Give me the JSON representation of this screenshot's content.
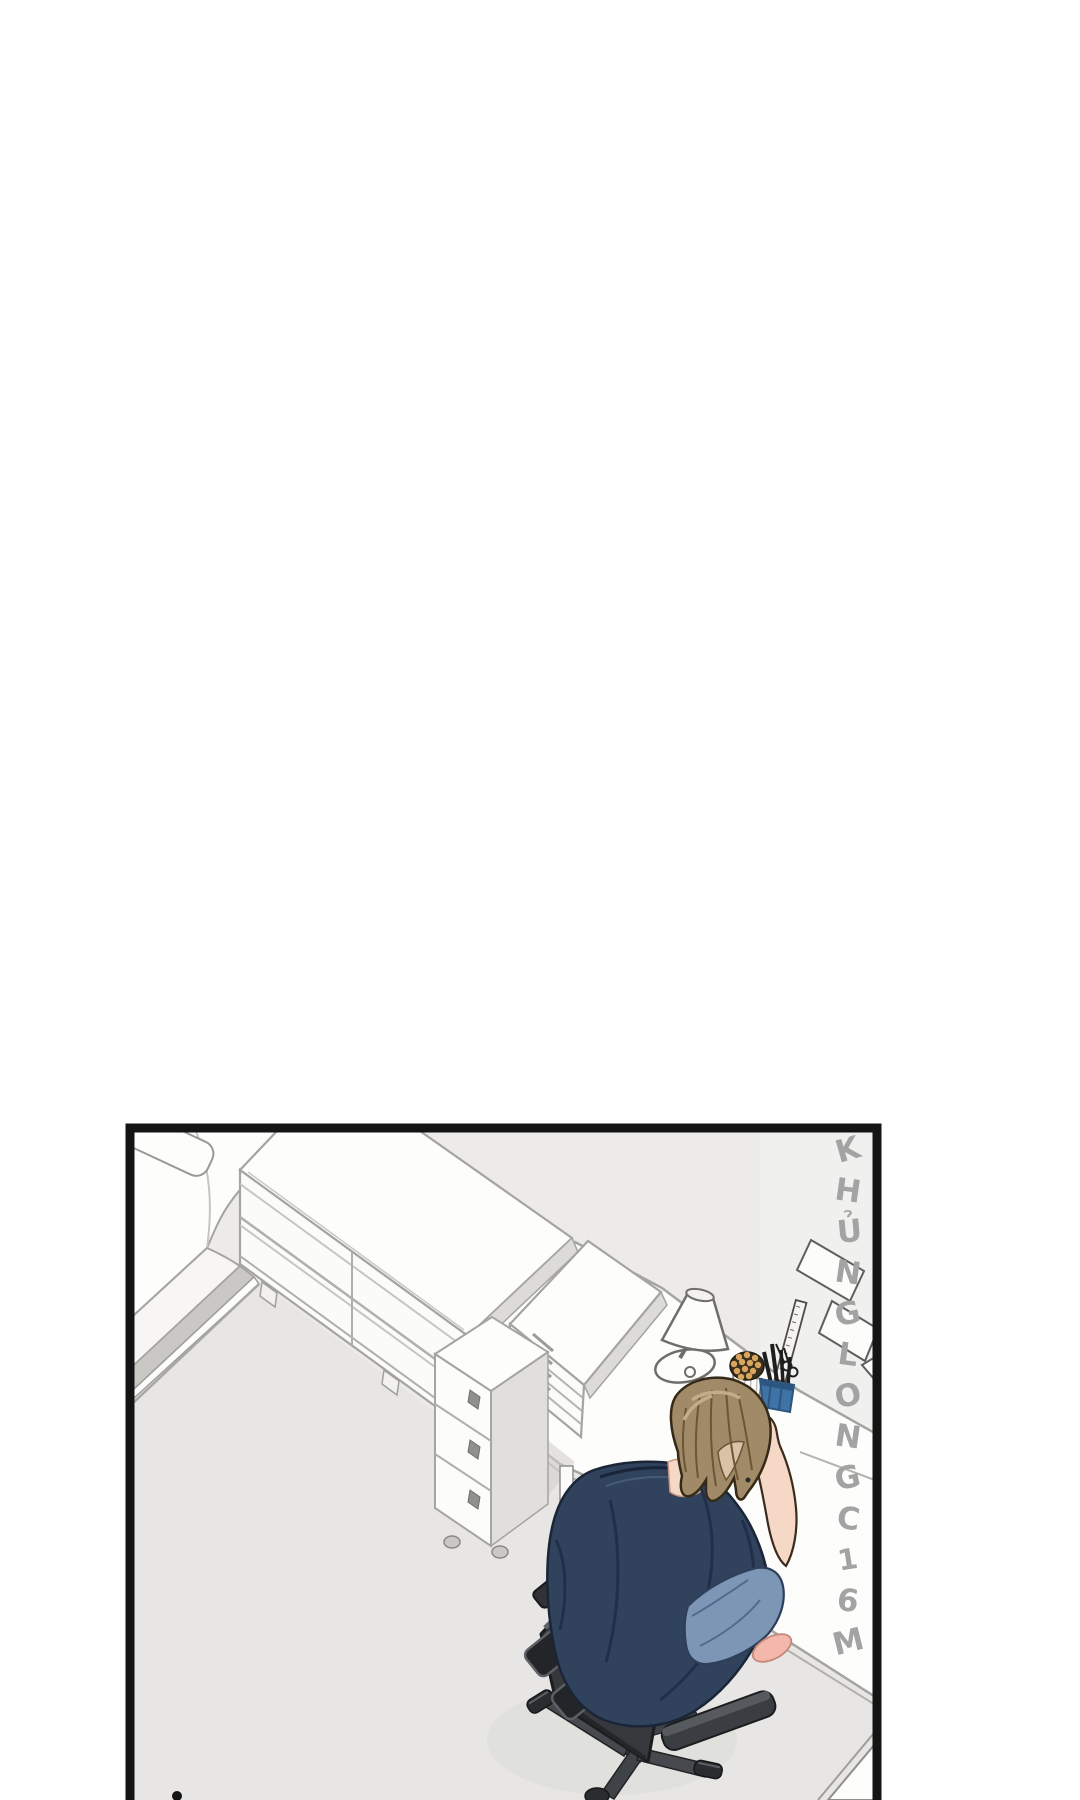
{
  "page": {
    "background": "#ffffff"
  },
  "panel": {
    "border_color": "#141414",
    "watermark": {
      "text": "KHỦNGLONGC16M",
      "letters": [
        "K",
        "H",
        "Ủ",
        "N",
        "G",
        "L",
        "O",
        "N",
        "G",
        "C",
        "1",
        "6",
        "M"
      ],
      "color": "#a3a3a3"
    },
    "colors": {
      "wall": "#ecebe9",
      "wall_light": "#f2f1ef",
      "floor": "#e7e6e4",
      "floor_shadow": "#d7d6d3",
      "furniture_white": "#fdfdfc",
      "furniture_line": "#a5a4a1",
      "furniture_shade": "#dcdbd8",
      "bed_rail": "#c9c8c4",
      "hair": "#a08a67",
      "hair_light": "#c0ad8b",
      "hair_dark": "#6b5737",
      "skin": "#f5d8c6",
      "shirt": "#31425c",
      "shirt_fold": "#20304a",
      "jeans": "#7d96b6",
      "slipper": "#f3b8ab",
      "chair_dark": "#2a2c30",
      "chair_mid": "#46494d",
      "chair_light": "#5d6065",
      "pen_cup_blue": "#3f72a5",
      "pen_cup_blue_dark": "#2c5680",
      "pencil_tan": "#d8a55e",
      "lamp_outline": "#6f6e6b"
    }
  }
}
